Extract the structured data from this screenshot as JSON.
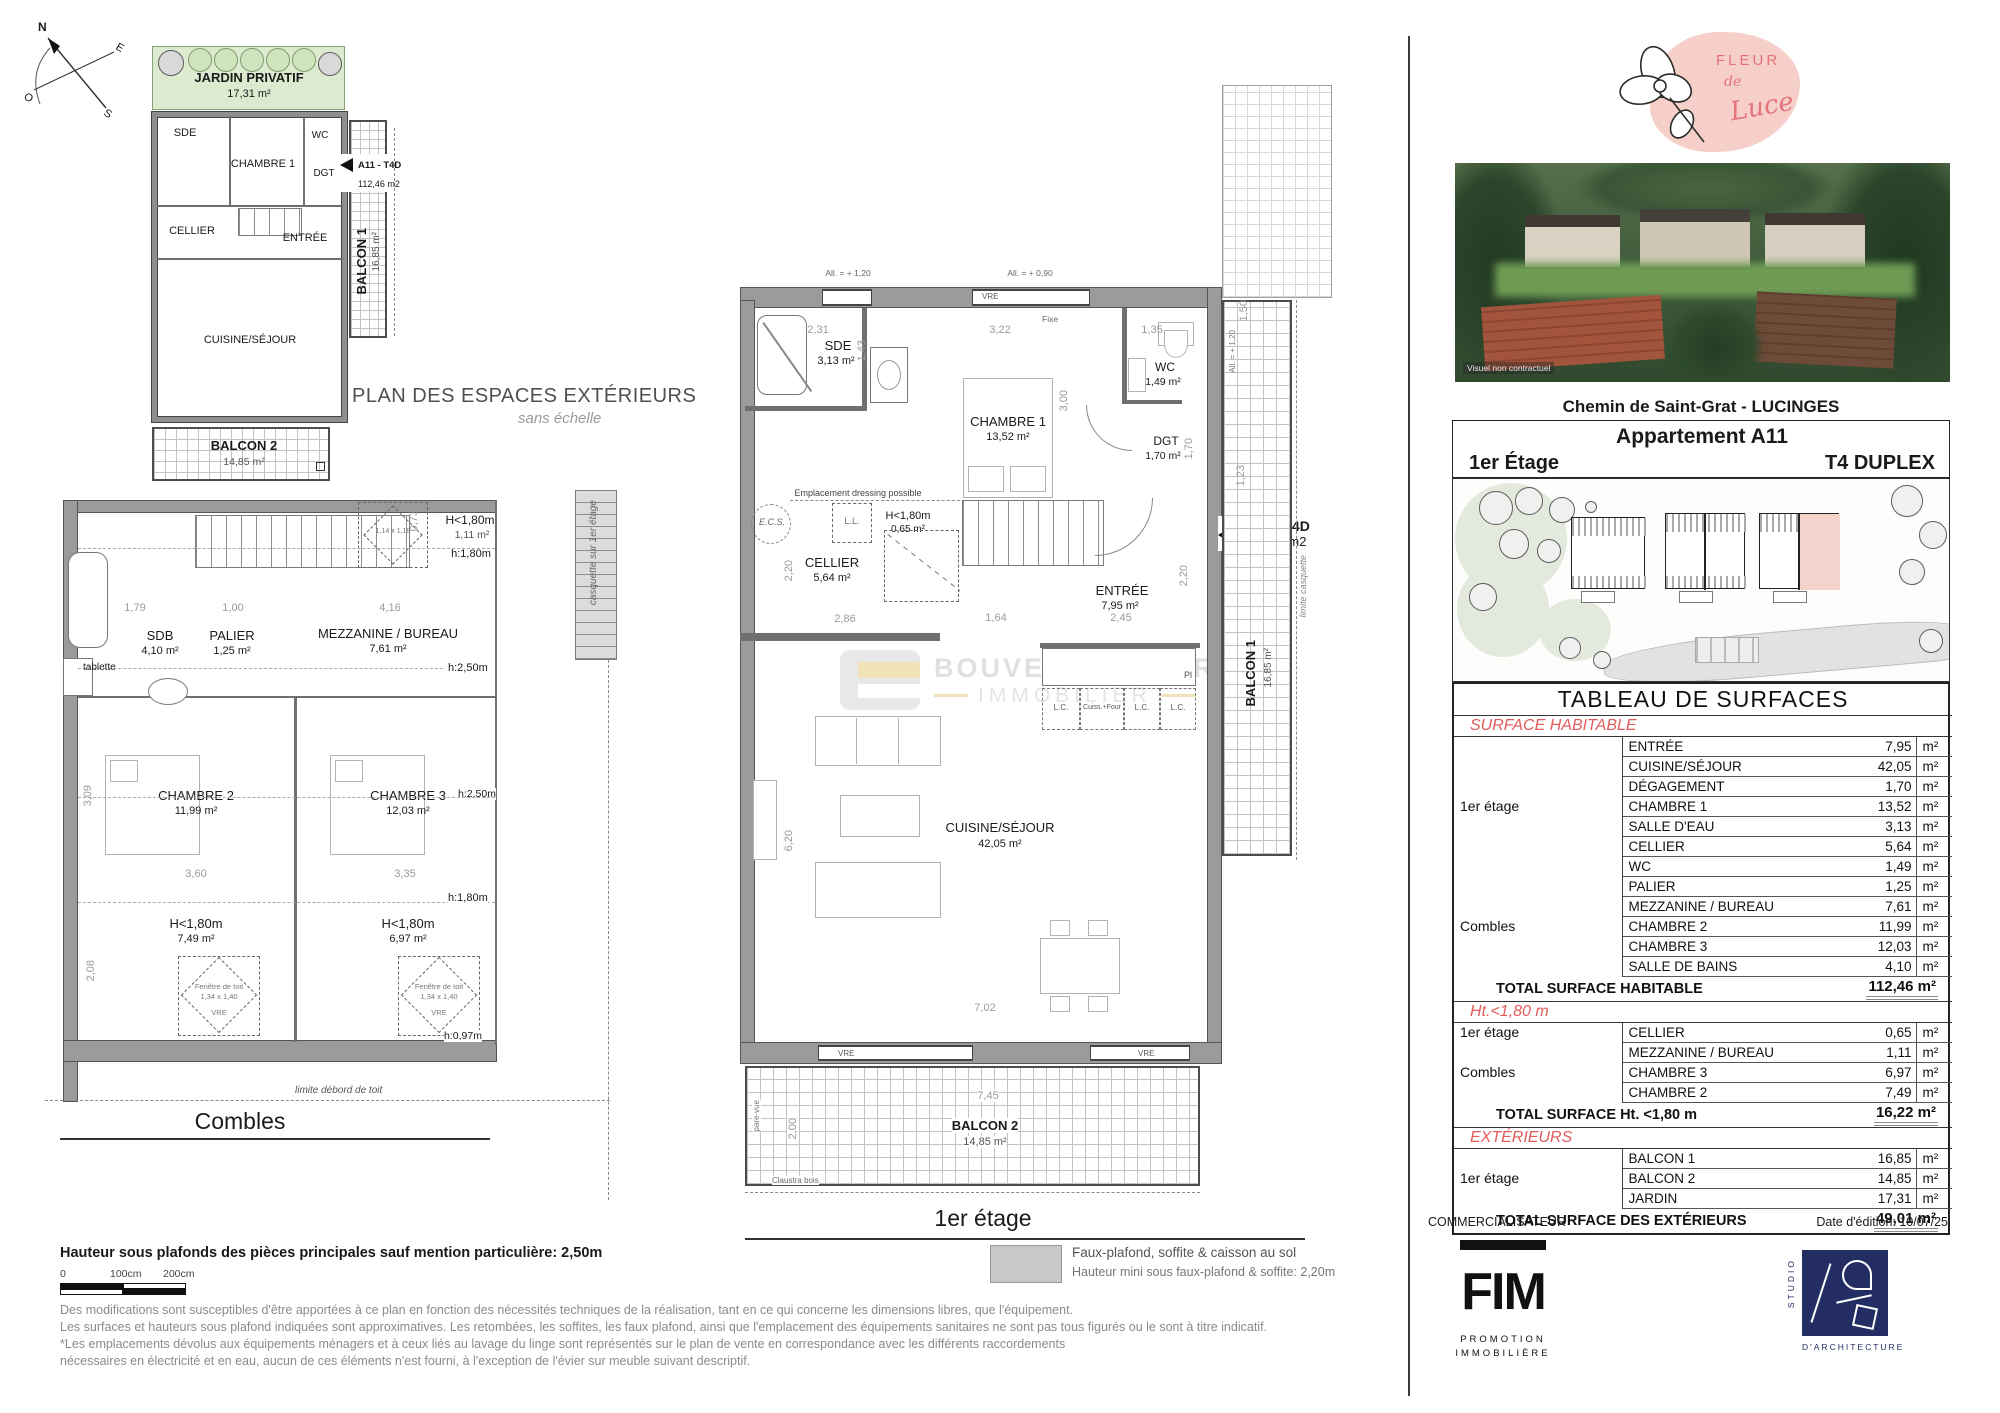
{
  "compass": {
    "n": "N",
    "e": "E",
    "s": "S",
    "o": "O"
  },
  "ext": {
    "title": "PLAN DES ESPACES EXTÉRIEURS",
    "subtitle": "sans échelle",
    "jardin": {
      "label": "JARDIN PRIVATIF",
      "area": "17,31 m²"
    },
    "rooms": {
      "sde": "SDE",
      "chambre1": "CHAMBRE 1",
      "wc": "WC",
      "dgt": "DGT",
      "cellier": "CELLIER",
      "entree": "ENTRÉE",
      "cuisine": "CUISINE/SÉJOUR"
    },
    "balcon1": {
      "label": "BALCON 1",
      "area": "16,85 m²"
    },
    "balcon2": {
      "label": "BALCON 2",
      "area": "14,85 m²"
    },
    "unit": {
      "tag": "A11 - T4D",
      "area": "112,46 m2"
    }
  },
  "combles": {
    "title": "Combles",
    "rooms": {
      "sdb": {
        "label": "SDB",
        "area": "4,10 m²"
      },
      "palier": {
        "label": "PALIER",
        "area": "1,25 m²"
      },
      "mezzanine": {
        "label": "MEZZANINE / BUREAU",
        "area": "7,61 m²"
      },
      "chambre2": {
        "label": "CHAMBRE 2",
        "area": "11,99 m²"
      },
      "chambre3": {
        "label": "CHAMBRE 3",
        "area": "12,03 m²"
      },
      "h180_top": {
        "label": "H<1,80m",
        "area": "1,11 m²"
      },
      "h180_left": {
        "label": "H<1,80m",
        "area": "7,49 m²"
      },
      "h180_right": {
        "label": "H<1,80m",
        "area": "6,97 m²"
      }
    },
    "notes": {
      "h180": "h:1,80m",
      "h250": "h:2,50m",
      "h097": "h:0,97m",
      "tablette": "tablette",
      "rw_small": {
        "l1": "Fenêtre de toit",
        "l2": "1,14 x 1,18",
        "l3": "VRE"
      },
      "rw": {
        "l1": "Fenêtre de toit",
        "l2": "1,34 x 1,40",
        "l3": "VRE"
      },
      "casquette": "casquette sur 1er étage",
      "limite": "limite débord de toit"
    },
    "dims": {
      "d200": "2,00",
      "d179": "1,79",
      "d100": "1,00",
      "d416": "4,16",
      "d309": "3,09",
      "d360": "3,60",
      "d335": "3,35",
      "d208": "2,08",
      "d073": "0,73"
    }
  },
  "etage": {
    "title": "1er étage",
    "rooms": {
      "sde": {
        "label": "SDE",
        "area": "3,13 m²"
      },
      "chambre1": {
        "label": "CHAMBRE 1",
        "area": "13,52 m²"
      },
      "wc": {
        "label": "WC",
        "area": "1,49 m²"
      },
      "dgt": {
        "label": "DGT",
        "area": "1,70 m²"
      },
      "cellier": {
        "label": "CELLIER",
        "area": "5,64 m²"
      },
      "entree": {
        "label": "ENTRÉE",
        "area": "7,95 m²"
      },
      "cuisine": {
        "label": "CUISINE/SÉJOUR",
        "area": "42,05 m²"
      },
      "h180": {
        "label": "H<1,80m",
        "area": "0,65 m²"
      },
      "balcon1": {
        "label": "BALCON 1",
        "area": "16,85 m²"
      },
      "balcon2": {
        "label": "BALCON 2",
        "area": "14,85 m²"
      }
    },
    "notes": {
      "all120": "All. = + 1,20",
      "all090": "All. = + 0,90",
      "all093": "All. = + 0,93",
      "seuil": "Seuil = ± 0,00",
      "vre": "VRE",
      "fixe": "Fixe",
      "dressing": "Emplacement dressing possible",
      "ecs": "E.C.S.",
      "ll": "L.L.",
      "pl": "Pl",
      "lc": "L.C.",
      "cuiss": "Cuiss.+Four",
      "pare_vue": "pare-vue",
      "claustra": "Claustra bois",
      "limite_casquette": "limite casquette"
    },
    "unit": {
      "tag": "A11 - T4D",
      "area": "112,46 m2"
    },
    "dims": {
      "d231": "2,31",
      "d143": "1,43",
      "d322": "3,22",
      "d300": "3,00",
      "d135": "1,35",
      "d170": "1,70",
      "d220": "2,20",
      "d286": "2,86",
      "d164": "1,64",
      "d245": "2,45",
      "d620": "6,20",
      "d702": "7,02",
      "d745": "7,45",
      "d200": "2,00",
      "d150": "1,50",
      "d123": "1,23"
    }
  },
  "wm": {
    "line1": "BOUVET CARTIER",
    "line2": "IMMOBILIER"
  },
  "legend": {
    "line1": "Faux-plafond, soffite & caisson au sol",
    "line2": "Hauteur mini sous faux-plafond & soffite: 2,20m"
  },
  "footer": {
    "height_note": "Hauteur sous plafonds des pièces principales sauf mention particulière: 2,50m",
    "scale": {
      "zero": "0",
      "s100": "100cm",
      "s200": "200cm"
    },
    "disclaimer": [
      "Des modifications sont susceptibles d'être apportées à ce plan en fonction des nécessités techniques de la réalisation, tant en ce qui concerne les dimensions libres, que l'équipement.",
      "Les surfaces et hauteurs sous plafond indiquées sont approximatives. Les retombées, les soffites, les faux plafond, ainsi que l'emplacement des équipements sanitaires ne sont pas tous figurés ou le sont à titre indicatif.",
      "*Les emplacements dévolus aux équipements ménagers et à ceux liés au lavage du linge sont représentés sur le plan de vente en correspondance avec les différents raccordements",
      "nécessaires en électricité et en eau, aucun de ces éléments n'est fourni, à l'exception de l'évier sur meuble suivant descriptif."
    ]
  },
  "panel": {
    "brand": {
      "l1": "FLEUR",
      "l2": "de",
      "l3": "Luce"
    },
    "photo_caption": "Visuel non contractuel",
    "address": "Chemin de Saint-Grat - LUCINGES",
    "header": {
      "apartment": "Appartement A11",
      "floor": "1er Étage",
      "type": "T4 DUPLEX"
    },
    "table": {
      "title": "TABLEAU DE SURFACES",
      "unit": "m²",
      "habitable": {
        "section": "SURFACE HABITABLE",
        "groups": [
          {
            "name": "1er étage",
            "rows": [
              [
                "ENTRÉE",
                "7,95"
              ],
              [
                "CUISINE/SÉJOUR",
                "42,05"
              ],
              [
                "DÉGAGEMENT",
                "1,70"
              ],
              [
                "CHAMBRE 1",
                "13,52"
              ],
              [
                "SALLE D'EAU",
                "3,13"
              ],
              [
                "CELLIER",
                "5,64"
              ],
              [
                "WC",
                "1,49"
              ]
            ]
          },
          {
            "name": "Combles",
            "rows": [
              [
                "PALIER",
                "1,25"
              ],
              [
                "MEZZANINE / BUREAU",
                "7,61"
              ],
              [
                "CHAMBRE 2",
                "11,99"
              ],
              [
                "CHAMBRE 3",
                "12,03"
              ],
              [
                "SALLE DE BAINS",
                "4,10"
              ]
            ]
          }
        ],
        "total_label": "TOTAL SURFACE HABITABLE",
        "total_value": "112,46 m²"
      },
      "ht180": {
        "section": "Ht.<1,80 m",
        "groups": [
          {
            "name": "1er étage",
            "rows": [
              [
                "CELLIER",
                "0,65"
              ]
            ]
          },
          {
            "name": "Combles",
            "rows": [
              [
                "MEZZANINE / BUREAU",
                "1,11"
              ],
              [
                "CHAMBRE 3",
                "6,97"
              ],
              [
                "CHAMBRE 2",
                "7,49"
              ]
            ]
          }
        ],
        "total_label": "TOTAL SURFACE Ht. <1,80 m",
        "total_value": "16,22 m²"
      },
      "exterieurs": {
        "section": "EXTÉRIEURS",
        "groups": [
          {
            "name": "1er étage",
            "rows": [
              [
                "BALCON 1",
                "16,85"
              ],
              [
                "BALCON 2",
                "14,85"
              ],
              [
                "JARDIN",
                "17,31"
              ]
            ]
          }
        ],
        "total_label": "TOTAL SURFACE  DES EXTÉRIEURS",
        "total_value": "49,01 m²"
      }
    },
    "commercialisateur": "COMMERCIALISATEUR",
    "edition": "Date d'édition: 10/07/25",
    "fim": {
      "name": "FIM",
      "l1": "PROMOTION",
      "l2": "IMMOBILIÈRE"
    },
    "studio": {
      "l1": "STUDIO",
      "l2": "D'ARCHITECTURE"
    }
  }
}
